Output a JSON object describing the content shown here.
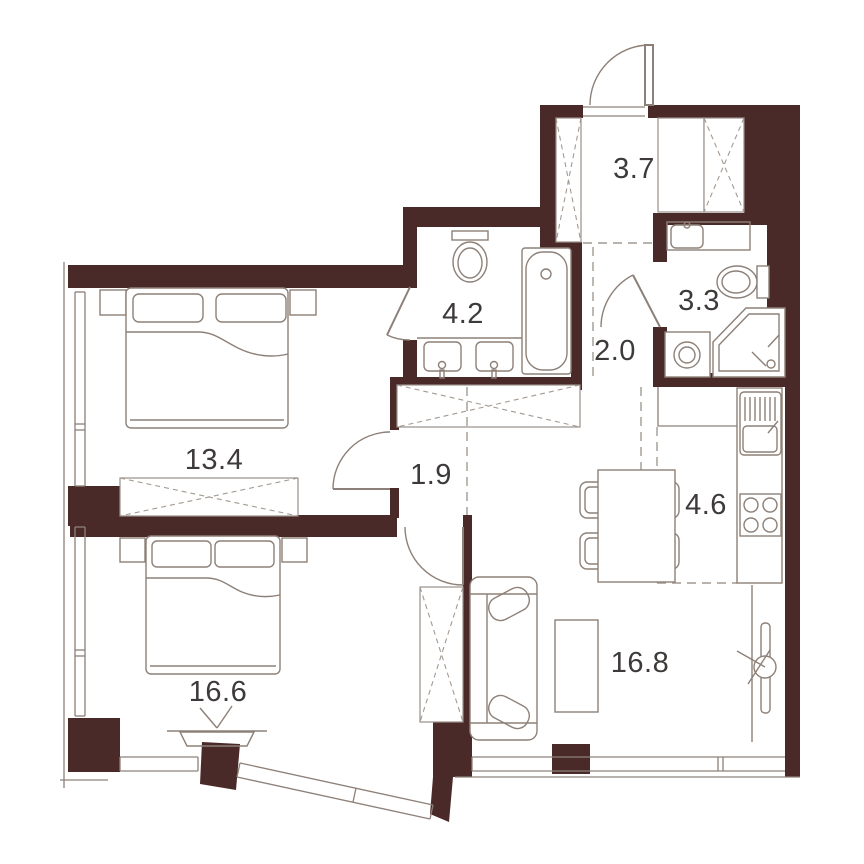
{
  "plan": {
    "type": "apartment-floor-plan",
    "colors": {
      "wall": "#4a2a29",
      "lines": "#8d8078",
      "dashes": "#a39a92",
      "label_text": "#3d3a39",
      "background": "#ffffff"
    },
    "rooms": [
      {
        "id": "entrance-hall",
        "area": "3.7"
      },
      {
        "id": "bathroom-main",
        "area": "4.2"
      },
      {
        "id": "shower-room",
        "area": "3.3"
      },
      {
        "id": "corridor",
        "area": "2.0"
      },
      {
        "id": "bedroom-1",
        "area": "13.4"
      },
      {
        "id": "inner-hall",
        "area": "1.9"
      },
      {
        "id": "kitchen",
        "area": "4.6"
      },
      {
        "id": "bedroom-2",
        "area": "16.6"
      },
      {
        "id": "living-room",
        "area": "16.8"
      }
    ],
    "symbols": [
      "entry-door",
      "wardrobe",
      "duct-shaft",
      "bathtub",
      "toilet",
      "sink",
      "double-sink",
      "shower-tray",
      "washing-machine",
      "double-bed",
      "nightstand",
      "pillow",
      "blanket",
      "sofa",
      "coffee-table",
      "tv",
      "dining-table",
      "chair",
      "kitchen-counter",
      "kitchen-sink",
      "stove",
      "window",
      "bay-window",
      "console-table",
      "door-swing",
      "zone-line"
    ]
  }
}
